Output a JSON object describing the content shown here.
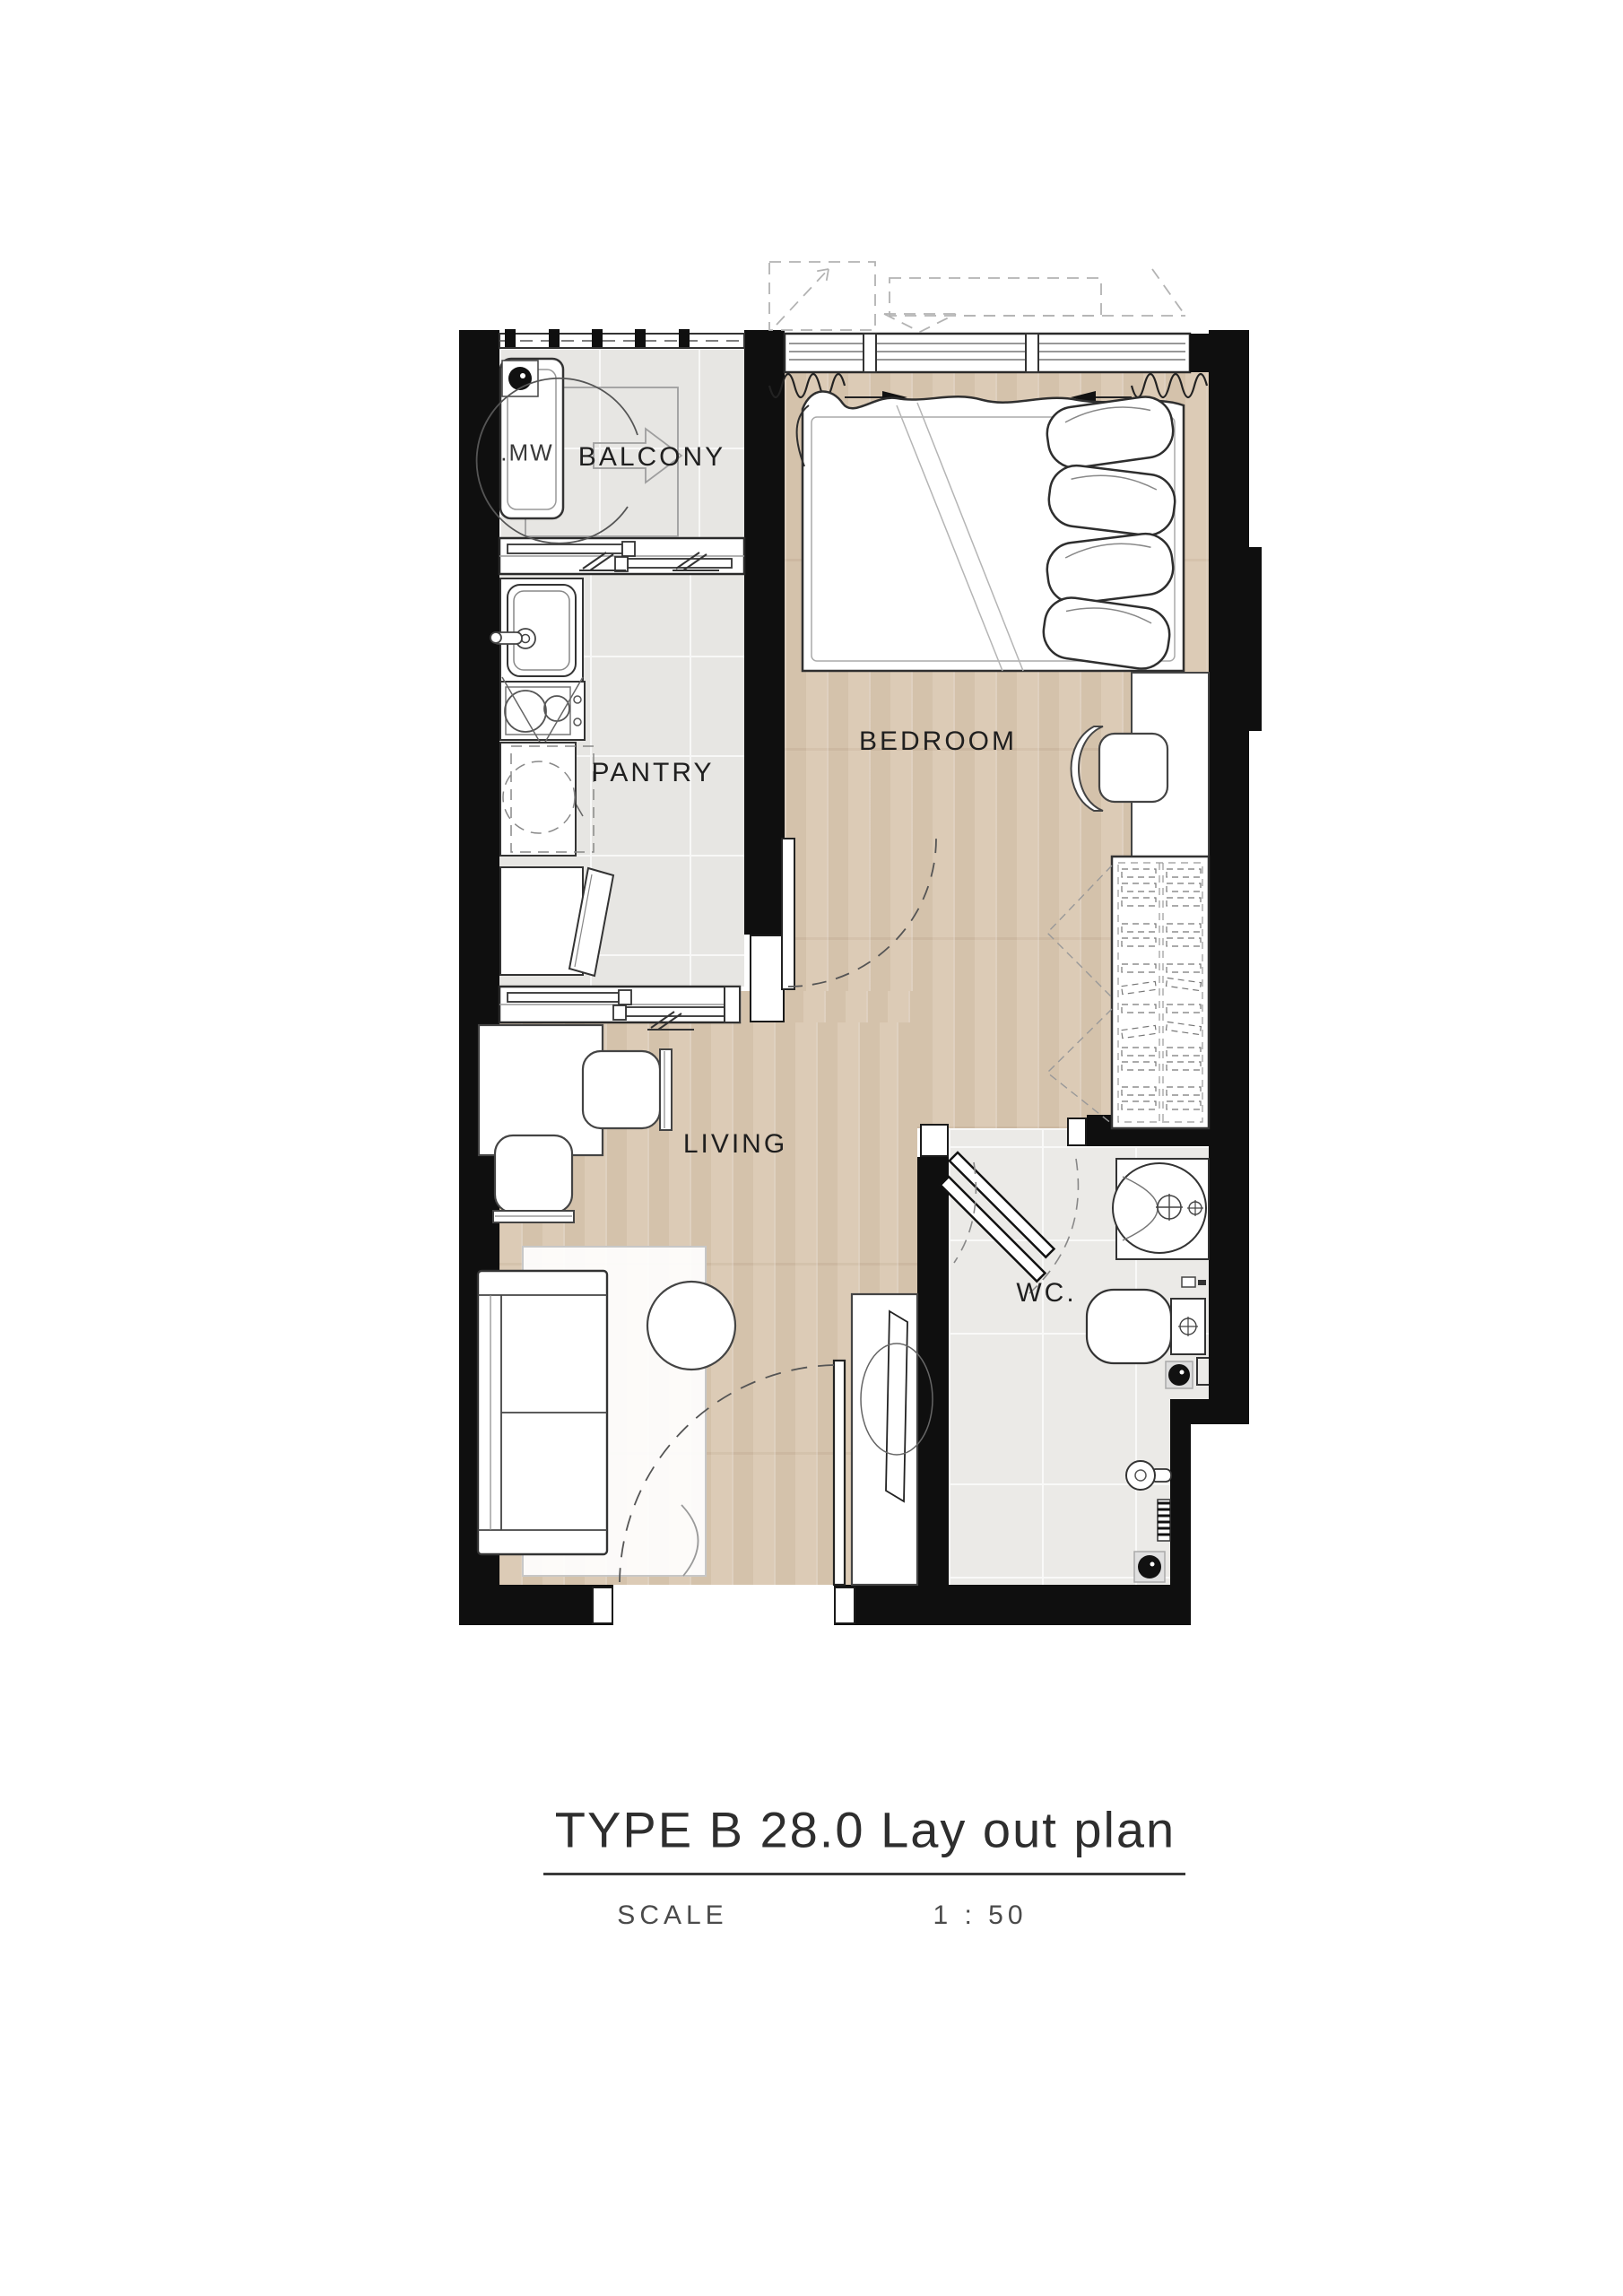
{
  "title_block": {
    "title": "TYPE B 28.0 Lay out plan",
    "scale_label": "SCALE",
    "scale_value": "1 : 50"
  },
  "room_labels": {
    "balcony": "BALCONY",
    "pantry": "PANTRY",
    "bedroom": "BEDROOM",
    "living": "LIVING",
    "wc": "WC.",
    "washing_machine": ".MW"
  },
  "colors": {
    "wall": "#0f0f0f",
    "wood_floor": "#dac9b4",
    "tile_floor": "#e7e6e3",
    "wc_tile_floor": "#ebeae7",
    "line": "#333333",
    "light_line": "#9a9a9a"
  }
}
